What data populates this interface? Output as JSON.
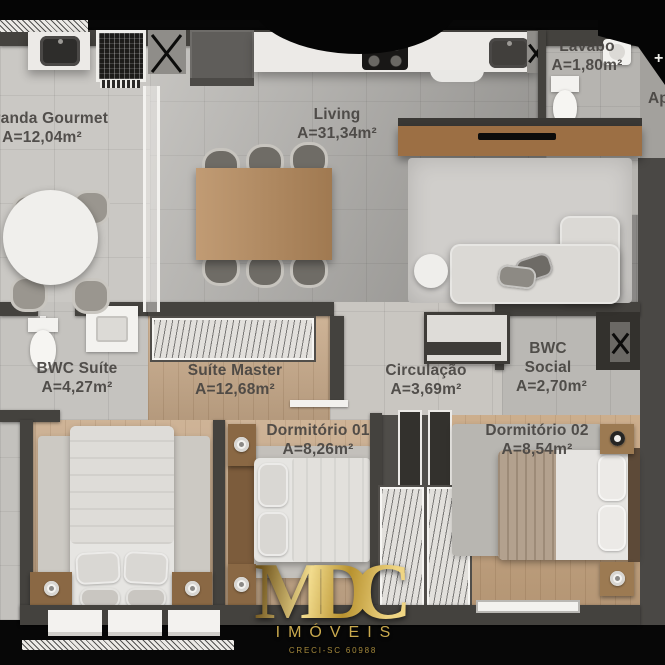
{
  "rooms": [
    {
      "name": "Varanda Gourmet",
      "area": "A=12,04m²"
    },
    {
      "name": "Living",
      "area": "A=31,34m²"
    },
    {
      "name": "Lavabo",
      "area": "A=1,80m²"
    },
    {
      "name": "BWC Suíte",
      "area": "A=4,27m²"
    },
    {
      "name": "Suíte Master",
      "area": "A=12,68m²"
    },
    {
      "name": "Circulação",
      "area": "A=3,69m²"
    },
    {
      "name": "BWC Social",
      "area": "A=2,70m²"
    },
    {
      "name": "Dormitório 01",
      "area": "A=8,26m²"
    },
    {
      "name": "Dormitório 02",
      "area": "A=8,54m²"
    }
  ],
  "edge": {
    "cutoff_label": "Ap",
    "corner_glyph": "+"
  },
  "branding": {
    "initials": "MDC",
    "name": "IMÓVEIS",
    "creci": "CRECI-SC 60988"
  },
  "colors": {
    "background": "#070707",
    "wall": "#44423e",
    "wood_floor": "#c9ab8b",
    "tile_floor": "#c6c4c0",
    "label_text": "#474441",
    "logo_gold": "#d3b15c"
  }
}
